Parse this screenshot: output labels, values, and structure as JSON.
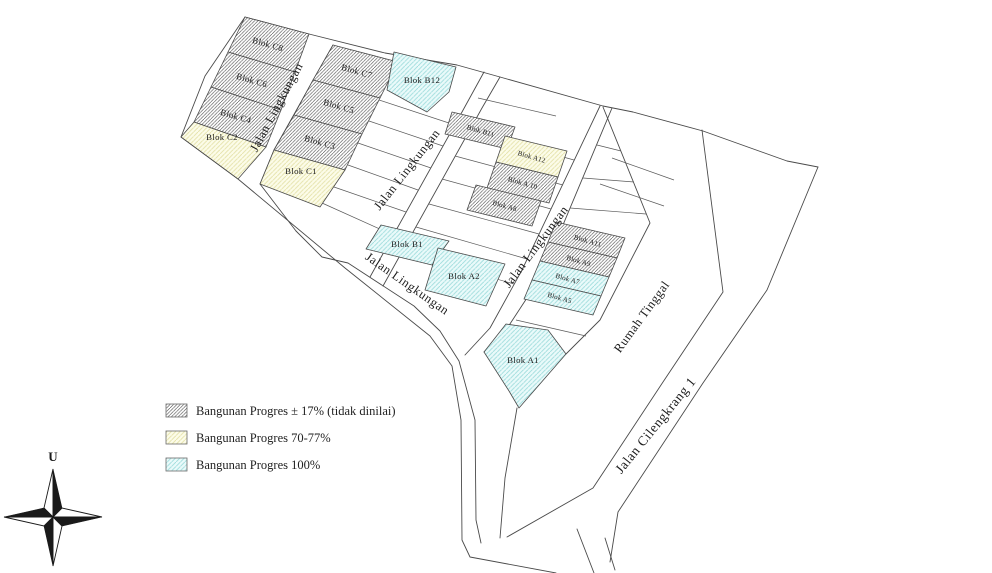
{
  "map": {
    "blocks": {
      "c8": {
        "label": "Blok C8",
        "status": "progress-17"
      },
      "c6": {
        "label": "Blok C6",
        "status": "progress-17"
      },
      "c4": {
        "label": "Blok C4",
        "status": "progress-17"
      },
      "c2": {
        "label": "Blok C2",
        "status": "progress-70-77"
      },
      "c7": {
        "label": "Blok C7",
        "status": "progress-17"
      },
      "c5": {
        "label": "Blok C5",
        "status": "progress-17"
      },
      "c3": {
        "label": "Blok C3",
        "status": "progress-17"
      },
      "c1": {
        "label": "Blok C1",
        "status": "progress-70-77"
      },
      "b12": {
        "label": "Blok B12",
        "status": "progress-100"
      },
      "b11": {
        "label": "Blok B11",
        "status": "progress-17"
      },
      "a12": {
        "label": "Blok A12",
        "status": "progress-70-77"
      },
      "a10": {
        "label": "Blok A 10",
        "status": "progress-17"
      },
      "a8": {
        "label": "Blok A8",
        "status": "progress-17"
      },
      "b1": {
        "label": "Blok B1",
        "status": "progress-100"
      },
      "a2": {
        "label": "Blok A2",
        "status": "progress-100"
      },
      "a11": {
        "label": "Blok A11",
        "status": "progress-17"
      },
      "a9": {
        "label": "Blok A9",
        "status": "progress-17"
      },
      "a7": {
        "label": "Blok A7",
        "status": "progress-100"
      },
      "a5": {
        "label": "Blok A5",
        "status": "progress-100"
      },
      "a1": {
        "label": "Blok A1",
        "status": "progress-100"
      }
    },
    "roads": {
      "jalan_lingkungan": "Jalan Lingkungan",
      "rumah_tinggal": "Rumah Tinggal",
      "jalan_cilengkrang_1": "Jalan Cilengkrang 1"
    },
    "compass": {
      "north_label": "U"
    }
  },
  "legend": {
    "items": [
      {
        "label": "Bangunan Progres ± 17% (tidak dinilai)",
        "swatch": "hatch-dark"
      },
      {
        "label": "Bangunan Progres 70-77%",
        "swatch": "hatch-yellow"
      },
      {
        "label": "Bangunan Progres 100%",
        "swatch": "hatch-cyan"
      }
    ]
  },
  "colors": {
    "line": "#4a4a4a",
    "hatch_dark_line": "#3c3c3c",
    "yellow_fill": "#fcfce9",
    "yellow_line": "#e4e1a8",
    "cyan_fill": "#eafafa",
    "cyan_line": "#9edcdc"
  }
}
